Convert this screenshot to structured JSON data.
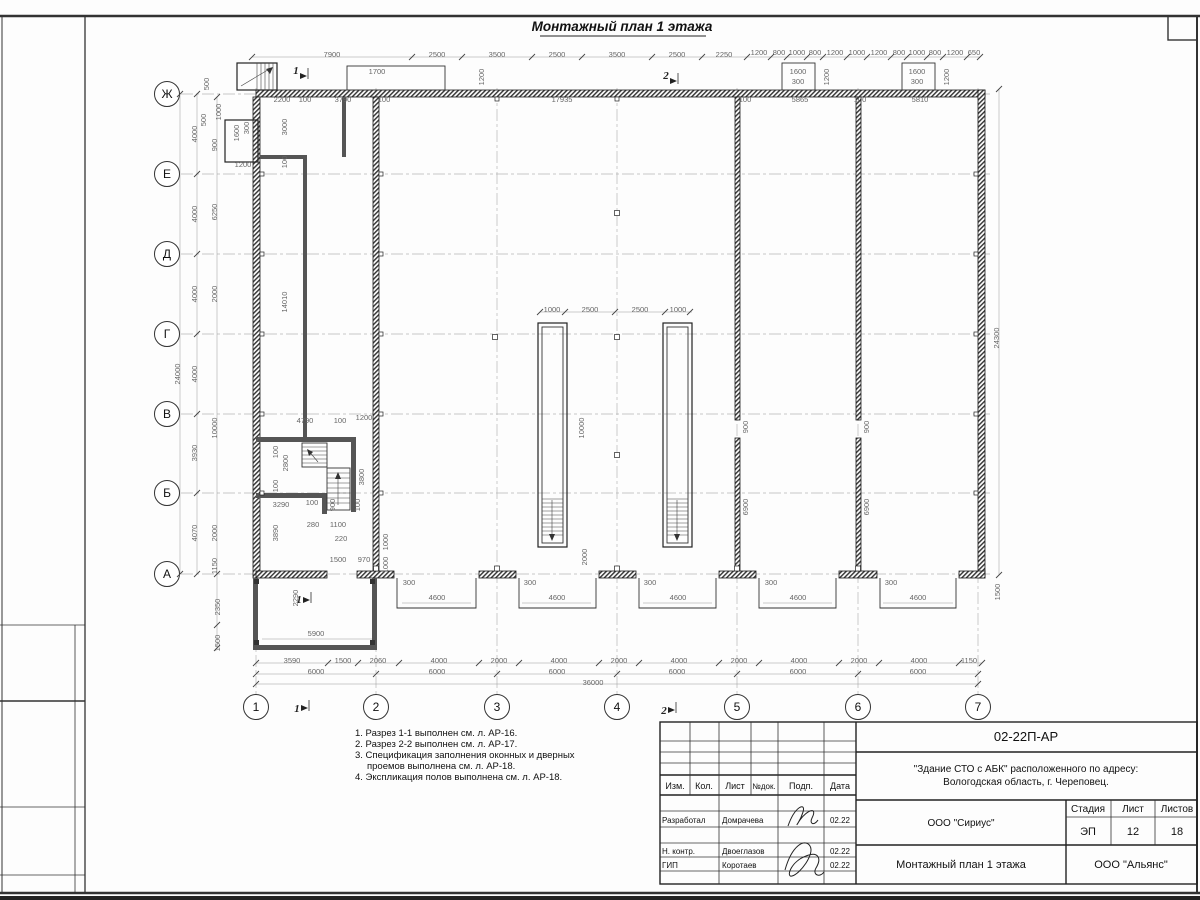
{
  "sheet": {
    "title": "Монтажный план 1 этажа",
    "doc_number": "02-22П-АР",
    "project_line1": "\"Здание СТО с АБК\" расположенного по адресу:",
    "project_line2": "Вологодская область, г. Череповец.",
    "company": "ООО \"Сириус\"",
    "contractor": "ООО \"Альянс\"",
    "drawing_name": "Монтажный план 1 этажа",
    "stage_label": "Стадия",
    "stage": "ЭП",
    "sheet_label": "Лист",
    "sheet_no": "12",
    "sheets_label": "Листов",
    "sheets_total": "18",
    "header_cols": [
      "Изм.",
      "Кол.",
      "Лист",
      "№док.",
      "Подп.",
      "Дата"
    ],
    "rows": [
      {
        "role": "Разработал",
        "name": "Домрачева",
        "date": "02.22"
      },
      {
        "role": "Н. контр.",
        "name": "Двоеглазов",
        "date": "02.22"
      },
      {
        "role": "ГИП",
        "name": "Коротаев",
        "date": "02.22"
      }
    ]
  },
  "notes": [
    "1. Разрез 1-1 выполнен см. л. АР-16.",
    "2. Разрез 2-2 выполнен см. л. АР-17.",
    "3. Спецификация заполнения оконных и дверных",
    "проемов выполнена см. л. АР-18.",
    "4. Экспликация полов выполнена см. л. АР-18."
  ],
  "axes": {
    "rows": [
      "Ж",
      "Е",
      "Д",
      "Г",
      "В",
      "Б",
      "А"
    ],
    "cols": [
      "1",
      "2",
      "3",
      "4",
      "5",
      "6",
      "7"
    ]
  },
  "plan": {
    "labels": [
      [
        "7900",
        332,
        57,
        0
      ],
      [
        "2500",
        437,
        57,
        0
      ],
      [
        "3500",
        497,
        57,
        0
      ],
      [
        "2500",
        557,
        57,
        0
      ],
      [
        "3500",
        617,
        57,
        0
      ],
      [
        "2500",
        677,
        57,
        0
      ],
      [
        "2250",
        724,
        57,
        0
      ],
      [
        "1200",
        759,
        55,
        0
      ],
      [
        "800",
        779,
        55,
        0
      ],
      [
        "1000",
        797,
        55,
        0
      ],
      [
        "800",
        815,
        55,
        0
      ],
      [
        "1200",
        835,
        55,
        0
      ],
      [
        "1000",
        857,
        55,
        0
      ],
      [
        "1200",
        879,
        55,
        0
      ],
      [
        "800",
        899,
        55,
        0
      ],
      [
        "1000",
        917,
        55,
        0
      ],
      [
        "800",
        935,
        55,
        0
      ],
      [
        "1200",
        955,
        55,
        0
      ],
      [
        "650",
        974,
        55,
        0
      ],
      [
        "2200",
        282,
        102,
        0
      ],
      [
        "100",
        305,
        102,
        0
      ],
      [
        "3790",
        343,
        102,
        0
      ],
      [
        "100",
        384,
        102,
        0
      ],
      [
        "17935",
        562,
        102,
        0
      ],
      [
        "100",
        745,
        102,
        0
      ],
      [
        "5865",
        800,
        102,
        0
      ],
      [
        "100",
        860,
        102,
        0
      ],
      [
        "5810",
        920,
        102,
        0
      ],
      [
        "1700",
        377,
        74,
        0
      ],
      [
        "1200",
        484,
        77,
        1
      ],
      [
        "1600",
        798,
        74,
        0
      ],
      [
        "300",
        798,
        84,
        0
      ],
      [
        "1200",
        829,
        77,
        1
      ],
      [
        "1600",
        917,
        74,
        0
      ],
      [
        "300",
        917,
        84,
        0
      ],
      [
        "1200",
        949,
        77,
        1
      ],
      [
        "500",
        209,
        84,
        1
      ],
      [
        "4000",
        197,
        134,
        1
      ],
      [
        "4000",
        197,
        214,
        1
      ],
      [
        "4000",
        197,
        294,
        1
      ],
      [
        "4000",
        197,
        374,
        1
      ],
      [
        "3930",
        197,
        453,
        1
      ],
      [
        "4070",
        197,
        533,
        1
      ],
      [
        "24000",
        180,
        374,
        1
      ],
      [
        "1000",
        221,
        112,
        1
      ],
      [
        "500",
        206,
        120,
        1
      ],
      [
        "900",
        217,
        145,
        1
      ],
      [
        "6250",
        217,
        212,
        1
      ],
      [
        "2000",
        217,
        294,
        1
      ],
      [
        "10000",
        217,
        428,
        1
      ],
      [
        "2000",
        217,
        533,
        1
      ],
      [
        "1150",
        217,
        566,
        1
      ],
      [
        "2350",
        220,
        607,
        1
      ],
      [
        "1500",
        220,
        643,
        1
      ],
      [
        "1600",
        239,
        133,
        1
      ],
      [
        "300",
        249,
        128,
        1
      ],
      [
        "1200",
        243,
        167,
        0
      ],
      [
        "3000",
        287,
        127,
        1
      ],
      [
        "100",
        287,
        162,
        1
      ],
      [
        "14010",
        287,
        302,
        1
      ],
      [
        "4790",
        305,
        423,
        0
      ],
      [
        "100",
        340,
        423,
        0
      ],
      [
        "1200",
        364,
        420,
        0
      ],
      [
        "100",
        278,
        452,
        1
      ],
      [
        "2800",
        288,
        463,
        1
      ],
      [
        "100",
        278,
        486,
        1
      ],
      [
        "3800",
        364,
        477,
        1
      ],
      [
        "3290",
        281,
        507,
        0
      ],
      [
        "100",
        312,
        505,
        0
      ],
      [
        "900",
        335,
        505,
        1
      ],
      [
        "100",
        360,
        505,
        1
      ],
      [
        "280",
        313,
        527,
        0
      ],
      [
        "1100",
        338,
        527,
        0
      ],
      [
        "220",
        341,
        541,
        0
      ],
      [
        "3890",
        278,
        533,
        1
      ],
      [
        "1000",
        388,
        542,
        1
      ],
      [
        "1000",
        388,
        565,
        1
      ],
      [
        "1500",
        338,
        562,
        0
      ],
      [
        "970",
        364,
        562,
        0
      ],
      [
        "1000",
        552,
        312,
        0
      ],
      [
        "2500",
        590,
        312,
        0
      ],
      [
        "2500",
        640,
        312,
        0
      ],
      [
        "1000",
        678,
        312,
        0
      ],
      [
        "10000",
        584,
        428,
        1
      ],
      [
        "2000",
        587,
        557,
        1
      ],
      [
        "900",
        748,
        427,
        1
      ],
      [
        "6900",
        748,
        507,
        1
      ],
      [
        "900",
        869,
        427,
        1
      ],
      [
        "6900",
        869,
        507,
        1
      ],
      [
        "24300",
        999,
        338,
        1
      ],
      [
        "1500",
        1000,
        592,
        1
      ],
      [
        "300",
        409,
        585,
        0
      ],
      [
        "300",
        530,
        585,
        0
      ],
      [
        "300",
        650,
        585,
        0
      ],
      [
        "300",
        771,
        585,
        0
      ],
      [
        "300",
        891,
        585,
        0
      ],
      [
        "4600",
        437,
        600,
        0
      ],
      [
        "4600",
        557,
        600,
        0
      ],
      [
        "4600",
        678,
        600,
        0
      ],
      [
        "4600",
        798,
        600,
        0
      ],
      [
        "4600",
        918,
        600,
        0
      ],
      [
        "2290",
        298,
        598,
        1
      ],
      [
        "5900",
        316,
        636,
        0
      ],
      [
        "3590",
        292,
        663,
        0
      ],
      [
        "1500",
        343,
        663,
        0
      ],
      [
        "2060",
        378,
        663,
        0
      ],
      [
        "4000",
        439,
        663,
        0
      ],
      [
        "2000",
        499,
        663,
        0
      ],
      [
        "4000",
        559,
        663,
        0
      ],
      [
        "2000",
        619,
        663,
        0
      ],
      [
        "4000",
        679,
        663,
        0
      ],
      [
        "2000",
        739,
        663,
        0
      ],
      [
        "4000",
        799,
        663,
        0
      ],
      [
        "2000",
        859,
        663,
        0
      ],
      [
        "4000",
        919,
        663,
        0
      ],
      [
        "1150",
        969,
        663,
        0
      ],
      [
        "6000",
        316,
        674,
        0
      ],
      [
        "6000",
        437,
        674,
        0
      ],
      [
        "6000",
        557,
        674,
        0
      ],
      [
        "6000",
        677,
        674,
        0
      ],
      [
        "6000",
        798,
        674,
        0
      ],
      [
        "6000",
        918,
        674,
        0
      ],
      [
        "36000",
        593,
        685,
        0
      ]
    ],
    "ticks": [
      {
        "y": 57,
        "xs": [
          252,
          412,
          462,
          532,
          582,
          652,
          702,
          747,
          771,
          787,
          807,
          823,
          847,
          867,
          891,
          907,
          927,
          943,
          967,
          980
        ]
      },
      {
        "y": 663,
        "xs": [
          256,
          328,
          358,
          399,
          479,
          519,
          599,
          639,
          719,
          759,
          839,
          879,
          959,
          982
        ]
      },
      {
        "y": 674,
        "xs": [
          256,
          376,
          497,
          617,
          737,
          858,
          978
        ]
      },
      {
        "y": 684,
        "xs": [
          256,
          978
        ]
      },
      {
        "x": 197,
        "ys": [
          94,
          174,
          254,
          334,
          414,
          493,
          574
        ]
      },
      {
        "x": 180,
        "ys": [
          94,
          574
        ]
      },
      {
        "x": 999,
        "ys": [
          89,
          575
        ]
      },
      {
        "y": 312,
        "xs": [
          540,
          565,
          615,
          665,
          690
        ]
      },
      {
        "x": 217,
        "ys": [
          97,
          574,
          625,
          648
        ]
      }
    ],
    "section_marks": [
      {
        "t": "1",
        "x": 296,
        "y": 74,
        "fx": 308,
        "fy": 76
      },
      {
        "t": "2",
        "x": 666,
        "y": 79,
        "fx": 678,
        "fy": 81
      },
      {
        "t": "1",
        "x": 299,
        "y": 603,
        "fx": 311,
        "fy": 600
      },
      {
        "t": "1",
        "x": 297,
        "y": 712,
        "fx": 309,
        "fy": 708
      },
      {
        "t": "2",
        "x": 664,
        "y": 714,
        "fx": 676,
        "fy": 710
      }
    ]
  }
}
